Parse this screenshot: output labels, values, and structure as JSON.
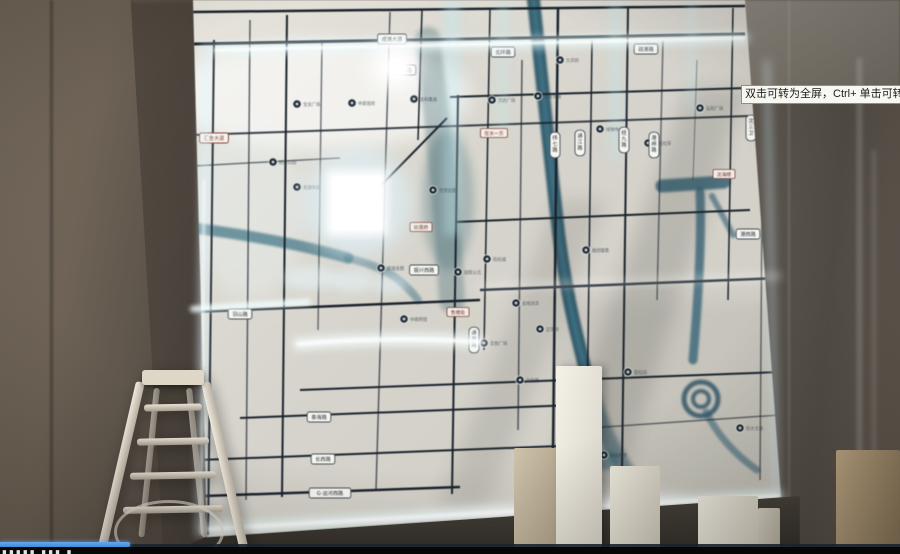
{
  "player": {
    "tooltip": "双击可转为全屏，Ctrl+ 单击可转为",
    "progress": {
      "percent": 14.4,
      "bar_color": "#3e8bdb"
    },
    "caption_glyphs": "▮▮▮▮▮ ▮▮▮ ▮"
  },
  "map": {
    "colors": {
      "board": "#dcd9d0",
      "road": "#1b242e",
      "river": "#2c6076",
      "edge_glow": "#e8fbff",
      "plate_text": "#2a333f",
      "plate_red": "#8a3a2e",
      "poi": "#141f2b"
    },
    "plates_h": [
      {
        "x": 392,
        "y": 39,
        "label": "成滩大道"
      },
      {
        "x": 404,
        "y": 70,
        "label": "港城路"
      },
      {
        "x": 214,
        "y": 138,
        "label": "汇金大道",
        "red": true
      },
      {
        "x": 503,
        "y": 52,
        "label": "北环路"
      },
      {
        "x": 646,
        "y": 49,
        "label": "疏港路"
      },
      {
        "x": 240,
        "y": 314,
        "label": "羽山路"
      },
      {
        "x": 424,
        "y": 270,
        "label": "振兴西路"
      },
      {
        "x": 319,
        "y": 417,
        "label": "泰海路"
      },
      {
        "x": 323,
        "y": 459,
        "label": "长西路"
      },
      {
        "x": 330,
        "y": 493,
        "label": "G·运河西路",
        "wide": true
      },
      {
        "x": 748,
        "y": 234,
        "label": "港西路"
      }
    ],
    "plates_v": [
      {
        "x": 555,
        "y": 145,
        "label": "纬七路"
      },
      {
        "x": 580,
        "y": 143,
        "label": "通江路"
      },
      {
        "x": 624,
        "y": 140,
        "label": "经九路"
      },
      {
        "x": 654,
        "y": 145,
        "label": "港闸路"
      },
      {
        "x": 751,
        "y": 128,
        "label": "沈三卫"
      },
      {
        "x": 474,
        "y": 340,
        "label": "通甲路"
      }
    ],
    "special_labels": [
      {
        "x": 494,
        "y": 133,
        "label": "在水一方"
      },
      {
        "x": 421,
        "y": 227,
        "label": "玖唐府"
      },
      {
        "x": 458,
        "y": 312,
        "label": "售楼处"
      },
      {
        "x": 724,
        "y": 174,
        "label": "沈海楼"
      }
    ],
    "pois": [
      {
        "x": 297,
        "y": 104,
        "label": "宝龙广场"
      },
      {
        "x": 352,
        "y": 103,
        "label": "中梁首府"
      },
      {
        "x": 414,
        "y": 99,
        "label": "金科集美"
      },
      {
        "x": 492,
        "y": 100,
        "label": "万达广场"
      },
      {
        "x": 538,
        "y": 96,
        "label": "建发悦城"
      },
      {
        "x": 560,
        "y": 60,
        "label": "九华府"
      },
      {
        "x": 600,
        "y": 129,
        "label": "绿地中心"
      },
      {
        "x": 648,
        "y": 143,
        "label": "保利拉菲"
      },
      {
        "x": 700,
        "y": 108,
        "label": "弘阳广场"
      },
      {
        "x": 273,
        "y": 162,
        "label": "招商公园"
      },
      {
        "x": 297,
        "y": 187,
        "label": "龙湖天街"
      },
      {
        "x": 433,
        "y": 190,
        "label": "世茂云图"
      },
      {
        "x": 381,
        "y": 268,
        "label": "新城金郡"
      },
      {
        "x": 404,
        "y": 319,
        "label": "中南熙悦"
      },
      {
        "x": 458,
        "y": 272,
        "label": "旭辉公元"
      },
      {
        "x": 487,
        "y": 259,
        "label": "阳光城"
      },
      {
        "x": 516,
        "y": 303,
        "label": "金地风华"
      },
      {
        "x": 540,
        "y": 329,
        "label": "正荣府"
      },
      {
        "x": 586,
        "y": 250,
        "label": "融创御景"
      },
      {
        "x": 628,
        "y": 372,
        "label": "碧桂园"
      },
      {
        "x": 604,
        "y": 455,
        "label": "绿城桃李"
      },
      {
        "x": 740,
        "y": 428,
        "label": "恒大文旅"
      },
      {
        "x": 484,
        "y": 343,
        "label": "吾悦广场"
      },
      {
        "x": 520,
        "y": 380,
        "label": "海伦堡"
      }
    ]
  }
}
